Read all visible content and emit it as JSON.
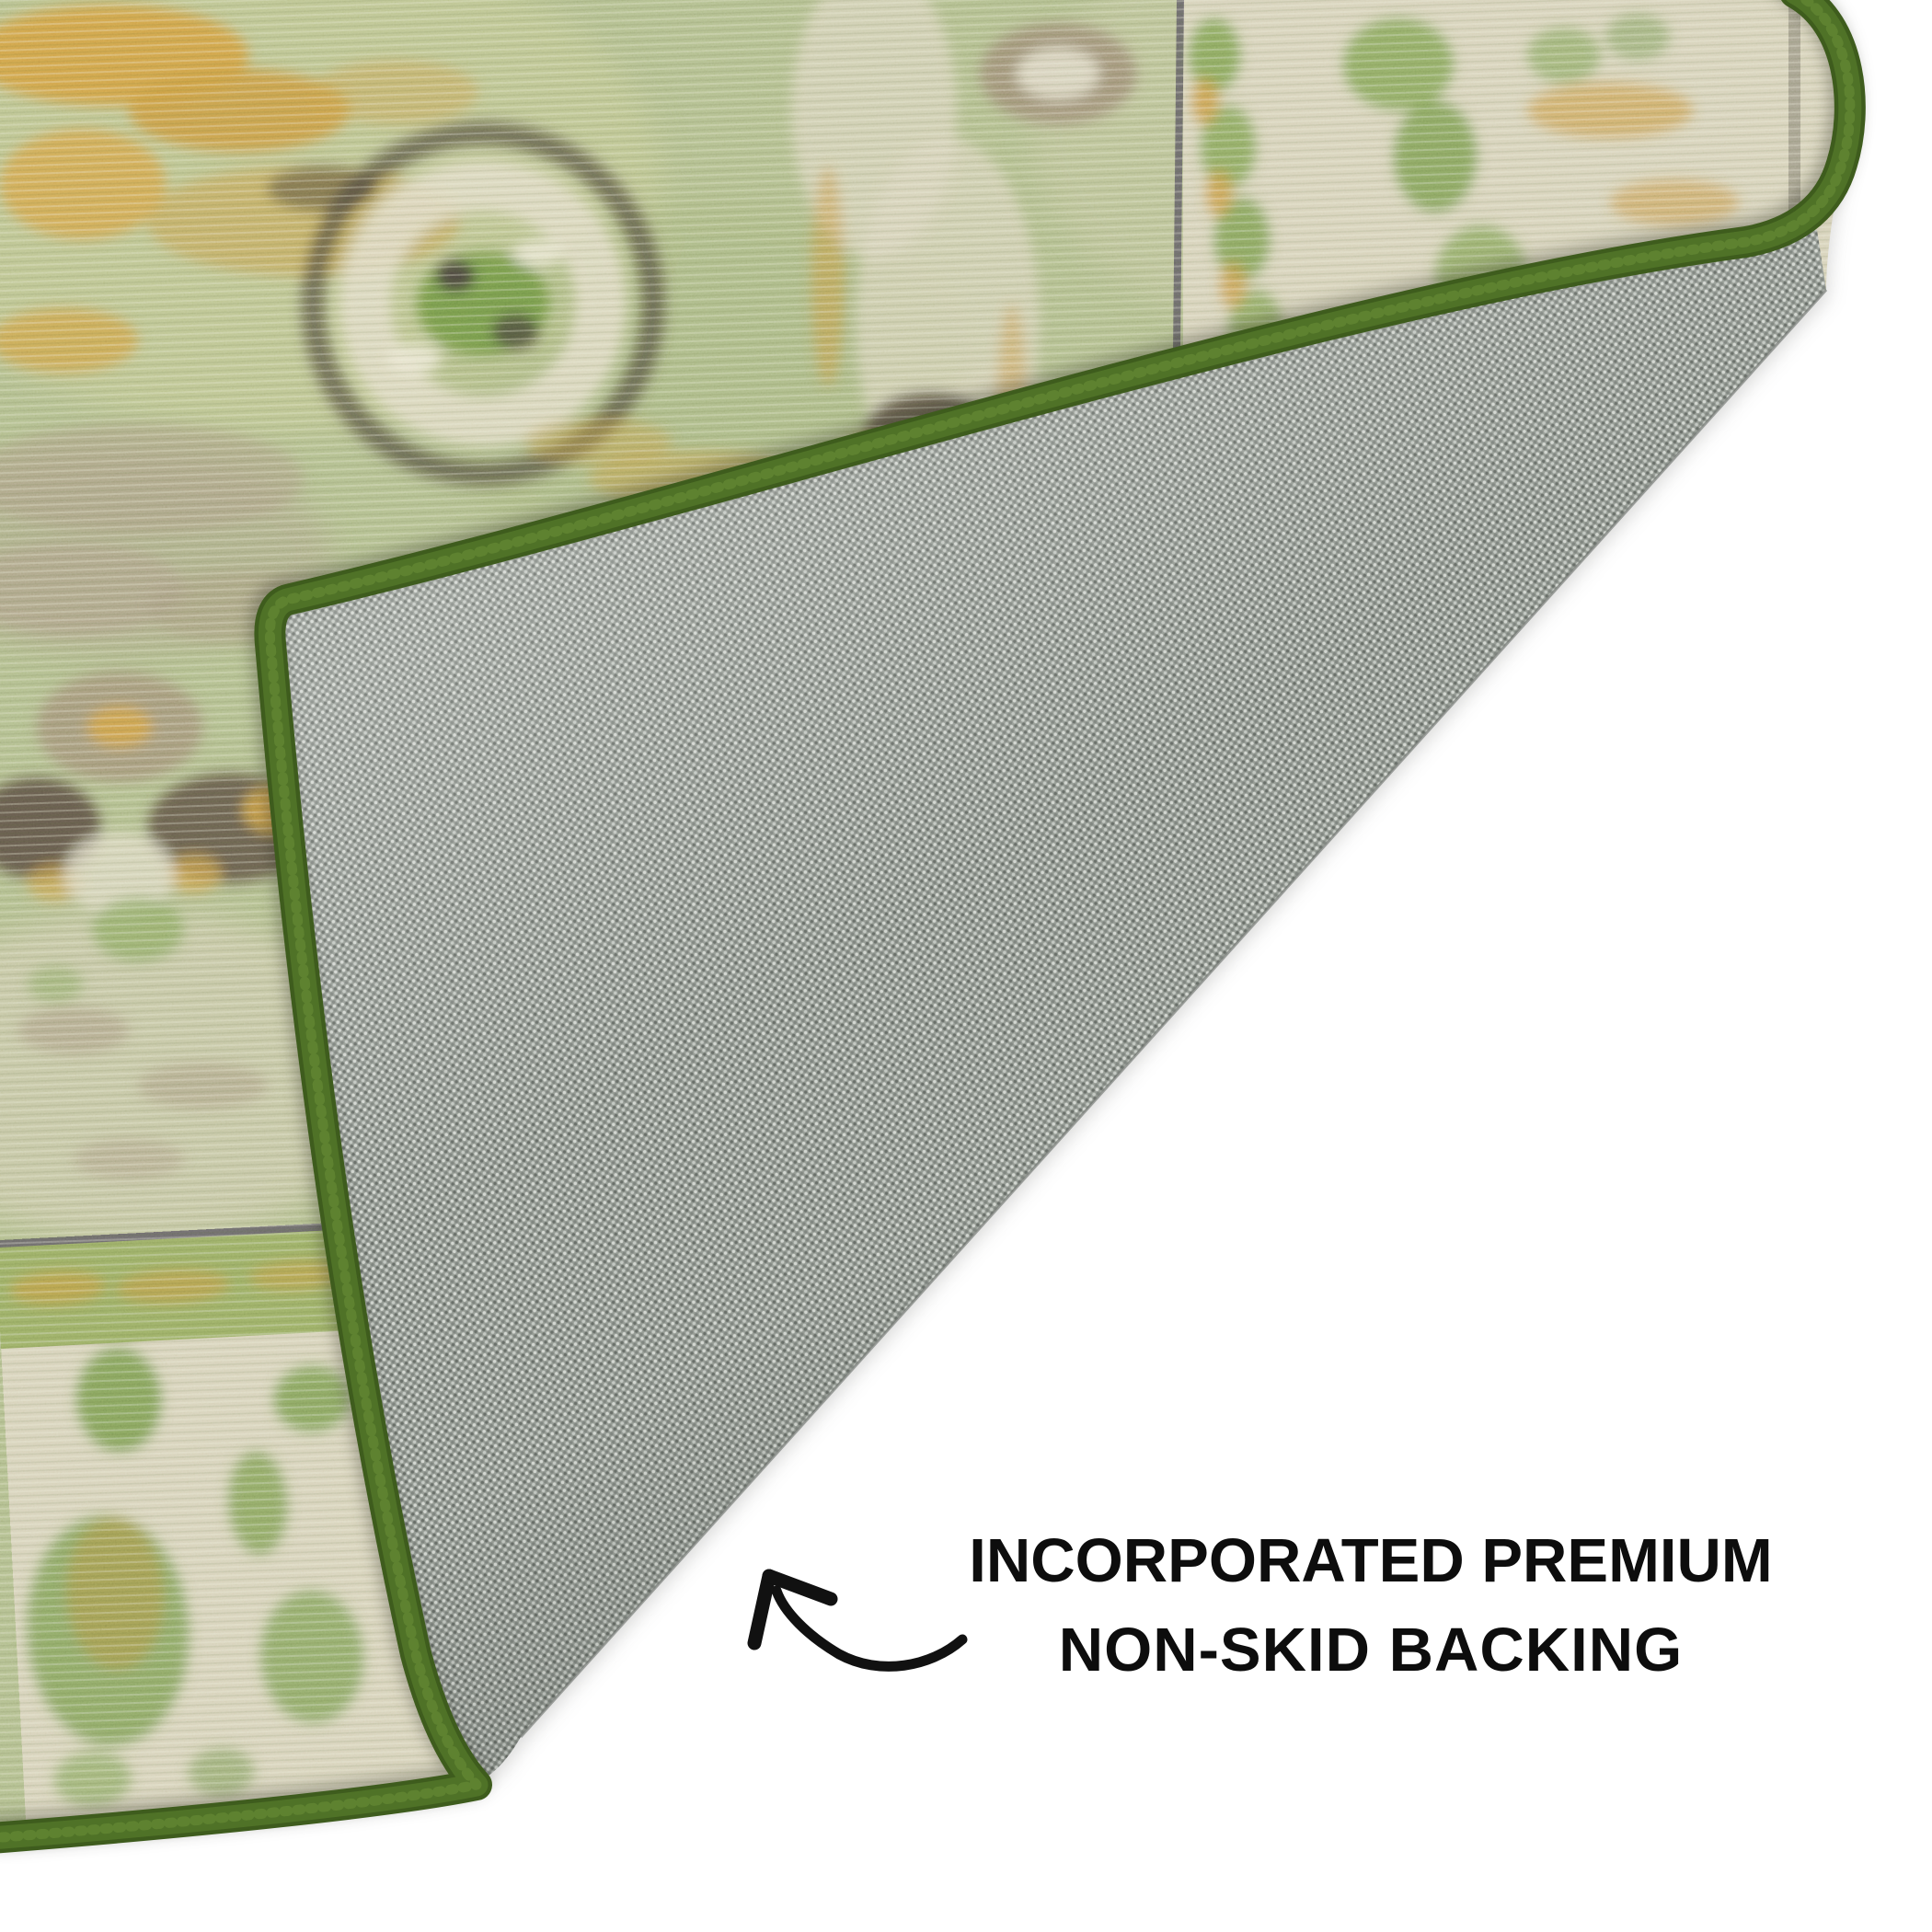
{
  "scene": {
    "type": "product-photo",
    "subject": "vintage oriental area rug with corner folded over to reveal gray non-skid backing"
  },
  "caption": {
    "line1": "INCORPORATED PREMIUM",
    "line2": "NON-SKID BACKING"
  },
  "icons": {
    "arrow": "hand-drawn-curved-arrow-up-left"
  },
  "colors": {
    "background": "#ffffff",
    "text": "#0d0d0d",
    "binding_green": "#4f7227",
    "binding_green_dark": "#3e5c1d",
    "binding_green_light": "#6c9038",
    "backing_gray": "#939992",
    "backing_gray_light": "#d2d6d0",
    "backing_gray_dark": "#666c66",
    "rug_field_sage": "#b0bc8a",
    "border_cream": "#d6d1b8",
    "accent_gold": "#cfa14a",
    "motif_taupe": "#a0907a",
    "motif_dark": "#54493e",
    "motif_green": "#74984a",
    "guard_line": "#57525e"
  }
}
